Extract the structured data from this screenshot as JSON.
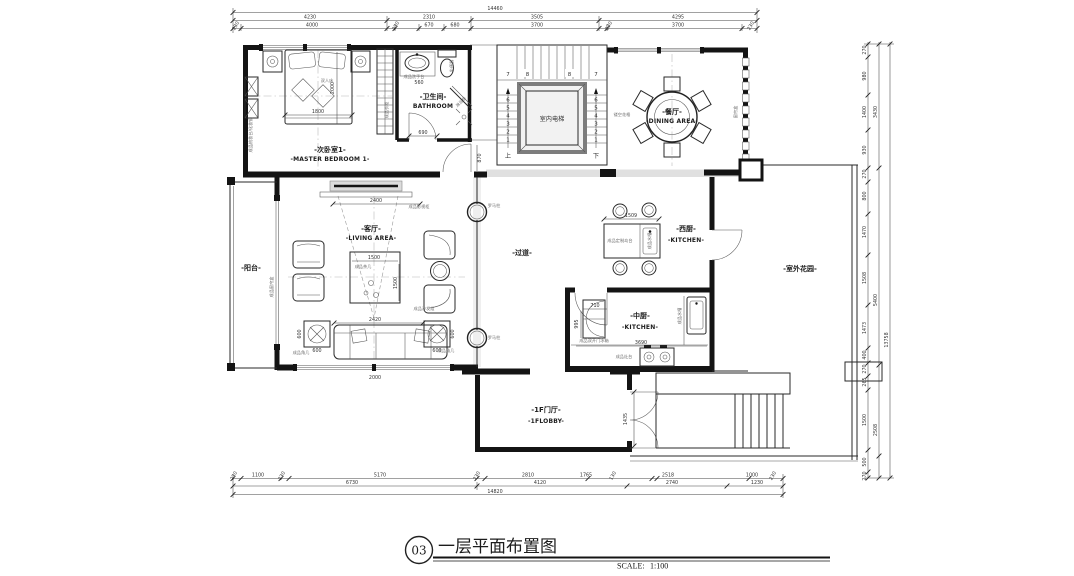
{
  "title_block": {
    "number": "03",
    "title": "一层平面布置图",
    "scale_label": "SCALE:",
    "scale_value": "1:100"
  },
  "rooms": {
    "bedroom": {
      "cn": "-次卧室1-",
      "en": "-MASTER BEDROOM 1-"
    },
    "bathroom": {
      "cn": "-卫生间-",
      "en": "BATHROOM"
    },
    "elevator": {
      "cn": "室内电梯"
    },
    "dining": {
      "cn": "-餐厅-",
      "en": "-DINING AREA-"
    },
    "balcony": {
      "cn": "-阳台-"
    },
    "living": {
      "cn": "-客厅-",
      "en": "-LIVING AREA-"
    },
    "corridor": {
      "cn": "-过道-"
    },
    "west_kitchen": {
      "cn": "-西厨-",
      "en": "-KITCHEN-"
    },
    "mid_kitchen": {
      "cn": "-中厨-",
      "en": "-KITCHEN-"
    },
    "lobby": {
      "cn": "-1F门厅-",
      "en": "-1FLOBBY-"
    },
    "garden": {
      "cn": "-室外花园-"
    }
  },
  "labels": {
    "double_bed": "双人床",
    "dresser": "成品梳妆台/化妆镜",
    "wardrobe": "成品衣柜",
    "basin": "成品洗手台",
    "toilet": "坐便器",
    "shower": "淋浴房",
    "lattice": "镂空花格",
    "curtain_box": "窗帘盒",
    "tv_cabinet": "成品影视柜",
    "coffee_table": "成品茶几",
    "sofa": "成品沙发组",
    "corner_table": "成品角几",
    "curtain": "成品窗帘盒",
    "column": "罗马柱",
    "island": "成品定制岛台",
    "island_sink": "成品水槽",
    "fridge": "成品双开门冰箱",
    "stove": "成品灶台",
    "sink": "成品水槽",
    "up": "上",
    "down": "下"
  },
  "stair_numbers": {
    "n1": "1",
    "n2": "2",
    "n3": "3",
    "n4": "4",
    "n5": "5",
    "n6": "6",
    "n7": "7",
    "n8": "8"
  },
  "dims": {
    "top_total": "14460",
    "top1": [
      "4230",
      "2310",
      "3505",
      "4295"
    ],
    "top2": [
      "230",
      "4000",
      "230",
      "670",
      "680",
      "3700",
      "230",
      "3700",
      "230"
    ],
    "bottom1": [
      "230",
      "1100",
      "230",
      "5170",
      "230",
      "2810",
      "1765",
      "130",
      "2518",
      "1000",
      "230"
    ],
    "bottom2": [
      "6730",
      "4120",
      "2740",
      "1230"
    ],
    "bottom_total": "14820",
    "right1": [
      "270",
      "980",
      "1400",
      "930",
      "270",
      "800",
      "1470",
      "1508",
      "1473",
      "400",
      "270",
      "265",
      "1500",
      "500",
      "270"
    ],
    "right2": [
      "3430",
      "5400",
      "2508"
    ],
    "right_total": "13758",
    "bed_w": "1800",
    "bed_d": "2000",
    "basin": "560",
    "bath_door": "690",
    "hall_door": "870",
    "tv": "2400",
    "ct_w": "1500",
    "ct_d": "1500",
    "sofa": "2420",
    "corner": "600",
    "living_s": "2000",
    "island": "1509",
    "fridge_w": "710",
    "fridge_d": "995",
    "counter": "3690",
    "entry_door": "1435"
  }
}
